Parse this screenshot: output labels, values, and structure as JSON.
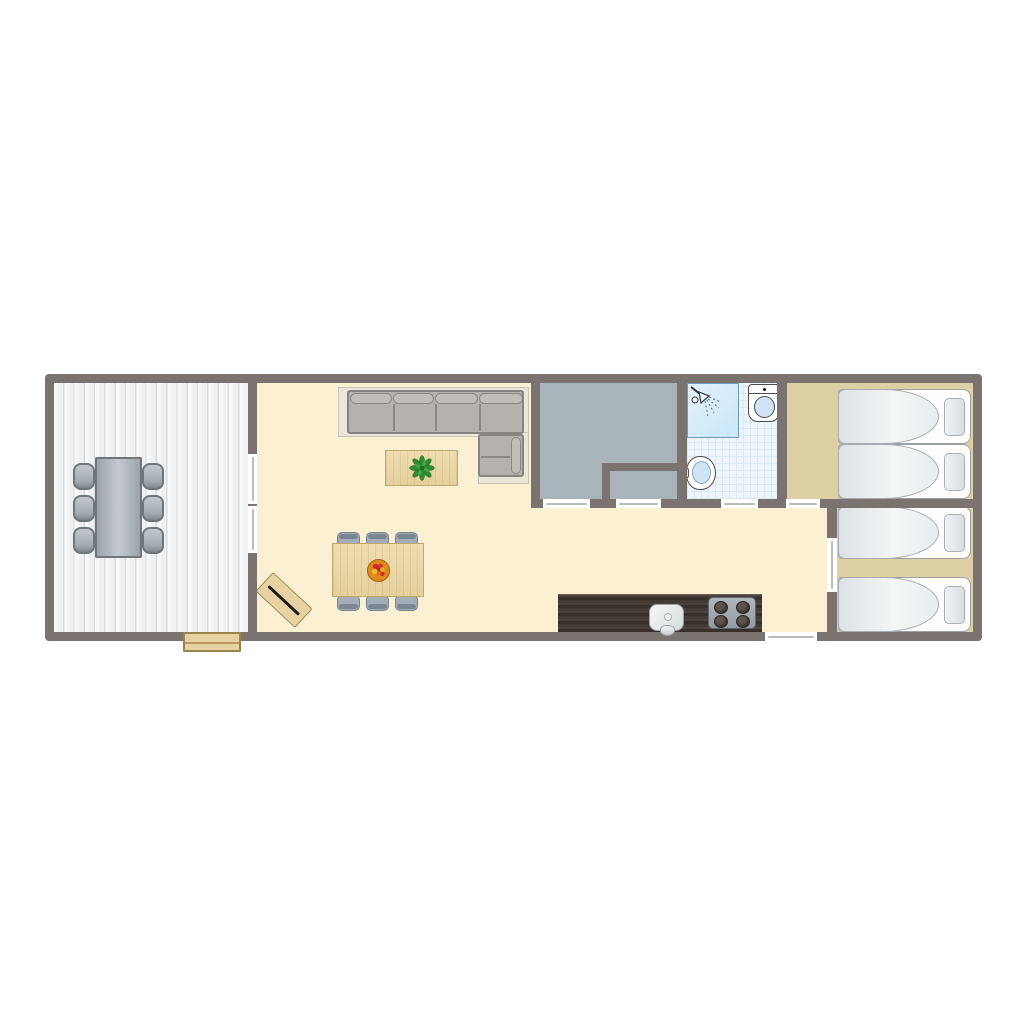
{
  "meta": {
    "type": "floor-plan",
    "description": "Top-down floor plan of an elongated holiday lodge with front deck, open living-dining-kitchen, middle bedroom with closet, bathroom and two twin bedrooms",
    "canvas": {
      "width": 1024,
      "height": 1024
    }
  },
  "palette": {
    "page_bg": "#ffffff",
    "wall": "#7b7370",
    "deck_plank_line": "#d9dcdf",
    "living_floor": "#fbf1d2",
    "mid_bedroom_floor": "#a9b3ba",
    "bathroom_floor": "#eef5fa",
    "bathroom_tile_line": "#d9e8f2",
    "shower_fill": "#c9e6f8",
    "shower_border": "#6d9cba",
    "right_bedroom_floor": "#ddd0a4",
    "bed_border": "#9aa1a6",
    "sofa_fill": "#b4b1ae",
    "sofa_border": "#87837f",
    "sofa_rug": "#eae6da",
    "wood_light": "#e7d2a2",
    "counter_dark": "#40382f",
    "furniture_gray_border": "#6e767c",
    "door_leaf": "#b9bcbe",
    "fixture_outline": "#4b4b4b",
    "fixture_blue": "#cfe4f4",
    "plant_green": "#2e8b2e",
    "fruit_bowl_orange": "#e08a1e"
  },
  "rooms": [
    {
      "name": "deck-terrace",
      "floor": "white wooden planks"
    },
    {
      "name": "living-dining-kitchen",
      "floor": "cream"
    },
    {
      "name": "middle-bedroom",
      "floor": "grey"
    },
    {
      "name": "closet",
      "floor": "grey"
    },
    {
      "name": "bathroom",
      "floor": "light-blue tiles"
    },
    {
      "name": "top-right-bedroom",
      "floor": "tan"
    },
    {
      "name": "bottom-right-bedroom",
      "floor": "tan"
    },
    {
      "name": "hallway",
      "floor": "cream"
    }
  ],
  "doors": [
    {
      "name": "deck-sliding-door-upper"
    },
    {
      "name": "deck-sliding-door-lower"
    },
    {
      "name": "middle-bedroom-door"
    },
    {
      "name": "closet-door"
    },
    {
      "name": "bathroom-door"
    },
    {
      "name": "top-bedroom-door"
    },
    {
      "name": "bottom-bedroom-door"
    },
    {
      "name": "entrance-door"
    }
  ],
  "furniture": {
    "deck": {
      "table": 1,
      "chairs": 6,
      "steps": 1
    },
    "living": {
      "corner_sofa": 1,
      "coffee_table": 1,
      "plant": 1,
      "dining_table": 1,
      "dining_chairs": 6,
      "fruit_bowl": 1,
      "doormat": 1
    },
    "kitchen": {
      "counter": 1,
      "sink": 1,
      "hob_burners": 4
    },
    "bathroom": {
      "shower": 1,
      "toilet": 1,
      "washbasin": 1
    },
    "bedrooms": {
      "single_beds": 4,
      "pillows": 4
    }
  }
}
